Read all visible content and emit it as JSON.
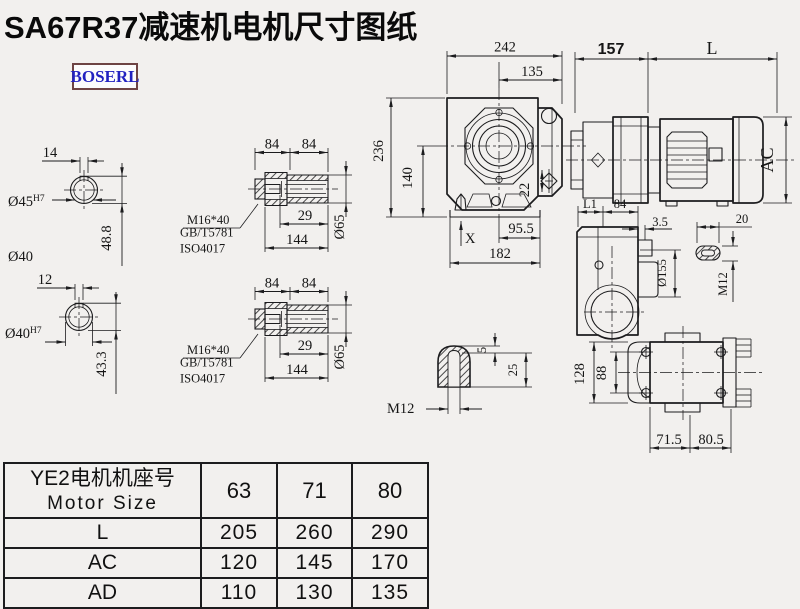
{
  "page": {
    "title": "SA67R37减速机电机尺寸图纸",
    "brand": "BOSERL",
    "background": "#f2f0ee",
    "ink_color": "#1c1c1e",
    "brand_text_color": "#2222c0",
    "brand_border_color": "#6e4444"
  },
  "dims": {
    "shaft1": {
      "keyway_width": "14",
      "bore": "Ø45",
      "bore_fit": "H7",
      "height": "48.8",
      "outer": "Ø40"
    },
    "shaft2": {
      "keyway_width": "12",
      "bore": "Ø40",
      "bore_fit": "H7",
      "height": "43.3"
    },
    "sleeve1": {
      "len_a": "84",
      "len_b": "84",
      "bolt": "M16*40",
      "standard1": "GB/T5781",
      "standard2": "ISO4017",
      "depth": "29",
      "length": "144",
      "dia": "Ø65"
    },
    "sleeve2": {
      "len_a": "84",
      "len_b": "84",
      "bolt": "M16*40",
      "standard1": "GB/T5781",
      "standard2": "ISO4017",
      "depth": "29",
      "length": "144",
      "dia": "Ø65"
    },
    "front": {
      "width": "242",
      "width_center": "135",
      "height": "236",
      "height_center": "140",
      "plug": "22",
      "base_a": "95.5",
      "base_b": "182",
      "marker": "X"
    },
    "motor": {
      "gear_length": "157",
      "motor_length": "L",
      "motor_dia": "AC"
    },
    "side": {
      "l1": "L1",
      "w84": "84",
      "lip": "3.5",
      "slot_w": "20",
      "flange_dia": "Ø155",
      "thread": "M12"
    },
    "key": {
      "depth": "5",
      "height": "25",
      "thread": "M12"
    },
    "bottom": {
      "width": "128",
      "bolt_span": "88",
      "base_a": "71.5",
      "base_b": "80.5"
    }
  },
  "table": {
    "header_cn": "YE2电机机座号",
    "header_en": "Motor Size",
    "sizes": [
      "63",
      "71",
      "80"
    ],
    "rows": [
      {
        "label": "L",
        "values": [
          "205",
          "260",
          "290"
        ]
      },
      {
        "label": "AC",
        "values": [
          "120",
          "145",
          "170"
        ]
      },
      {
        "label": "AD",
        "values": [
          "110",
          "130",
          "135"
        ]
      }
    ]
  }
}
